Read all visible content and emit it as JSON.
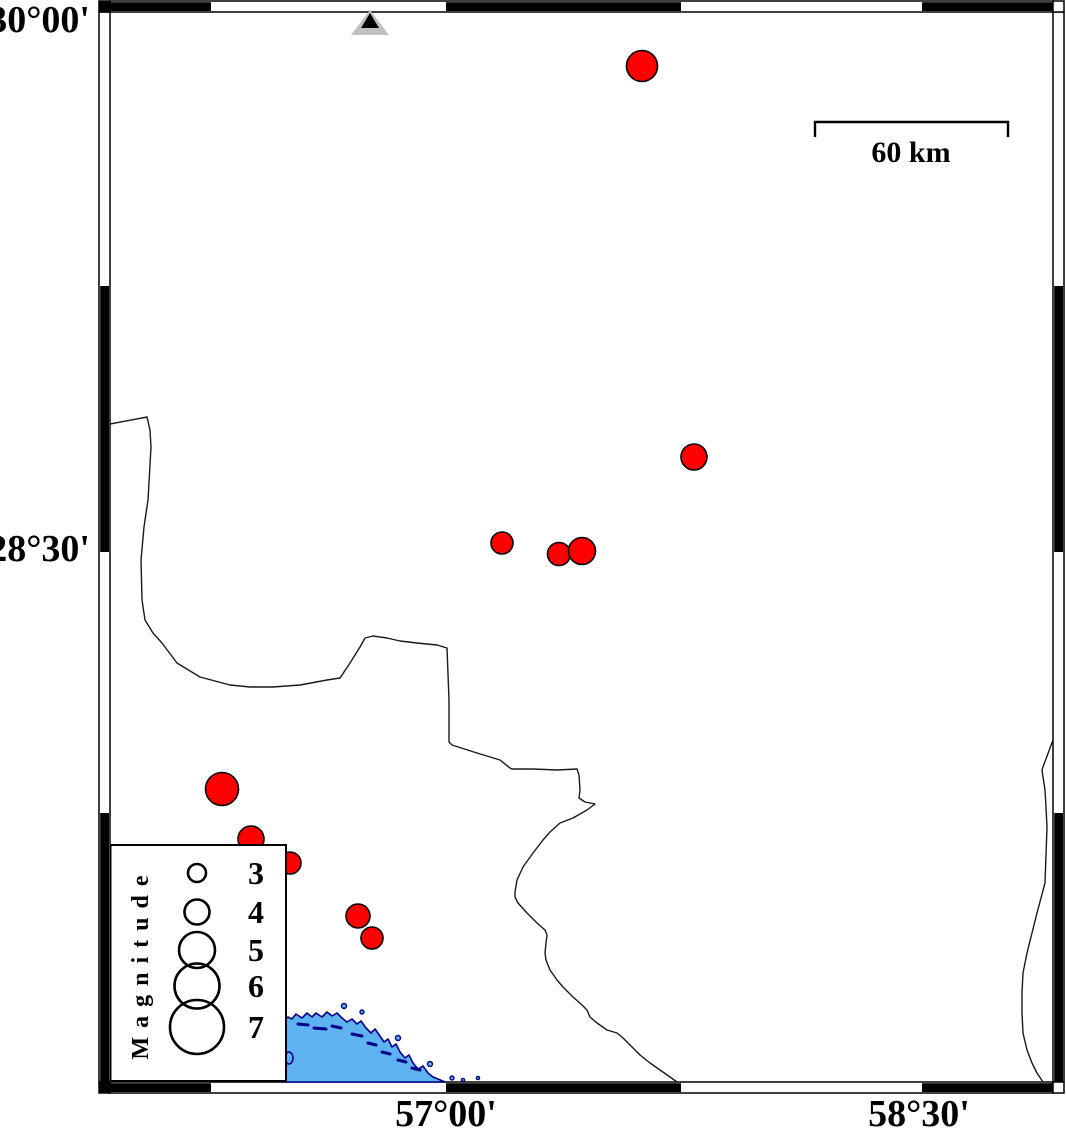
{
  "axes": {
    "lat_top": "30°00'",
    "lat_mid": "28°30'",
    "lon_left": "57°00'",
    "lon_right": "58°30'"
  },
  "scale_bar": {
    "label": "60 km",
    "length_km": 60
  },
  "legend": {
    "title": "Magnitude",
    "entries": [
      {
        "magnitude": "3",
        "r": 9,
        "cy": 873
      },
      {
        "magnitude": "4",
        "r": 12.5,
        "cy": 912
      },
      {
        "magnitude": "5",
        "r": 18,
        "cy": 950
      },
      {
        "magnitude": "6",
        "r": 22.5,
        "cy": 986
      },
      {
        "magnitude": "7",
        "r": 27,
        "cy": 1027
      }
    ]
  },
  "earthquakes": {
    "marker": "filled-red-circle",
    "points": [
      {
        "cx": 642,
        "cy": 66,
        "r": 15.5
      },
      {
        "cx": 694,
        "cy": 457,
        "r": 13
      },
      {
        "cx": 502,
        "cy": 543,
        "r": 11
      },
      {
        "cx": 559,
        "cy": 554,
        "r": 11.5
      },
      {
        "cx": 582,
        "cy": 551,
        "r": 13.5
      },
      {
        "cx": 222,
        "cy": 789,
        "r": 16.5
      },
      {
        "cx": 251,
        "cy": 839,
        "r": 13
      },
      {
        "cx": 290,
        "cy": 863,
        "r": 11
      },
      {
        "cx": 358,
        "cy": 916,
        "r": 12
      },
      {
        "cx": 372,
        "cy": 938,
        "r": 11
      }
    ]
  },
  "station": {
    "symbol": "triangle",
    "cx": 370,
    "cy": 23
  },
  "colors": {
    "epicenter_fill": "#FF0000",
    "water_fill": "#5EB2F0",
    "water_outline": "#00008B",
    "station_fill": "#C0C0C0",
    "frame": "#000000"
  }
}
